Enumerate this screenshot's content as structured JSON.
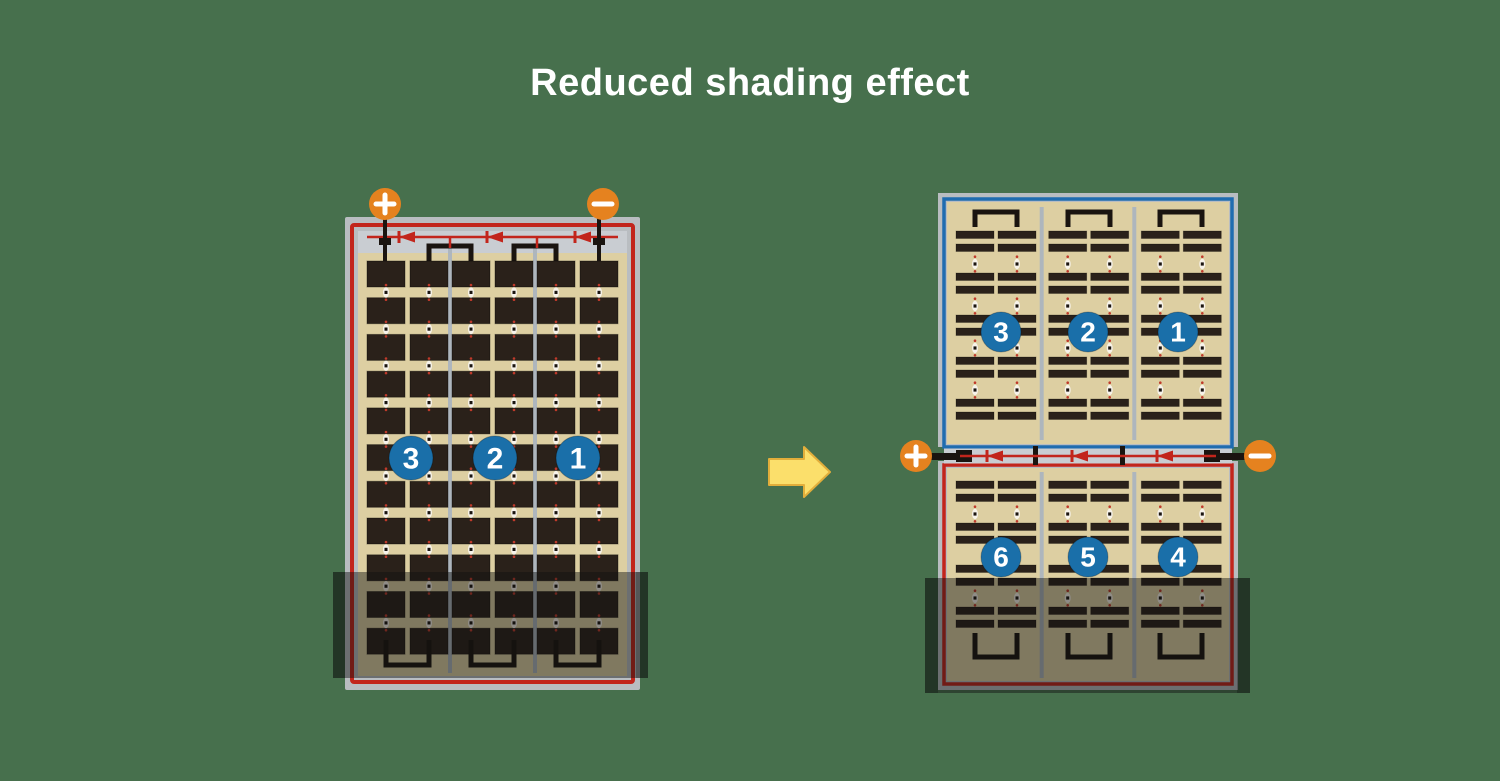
{
  "title": "Reduced shading effect",
  "colors": {
    "background": "#47704d",
    "title_text": "#ffffff",
    "panel_frame": "#b9bdc1",
    "panel_interior": "#ddcfa2",
    "busbar_gray": "#c9cdd2",
    "divider_gray": "#aeb6bd",
    "cell_dark": "#2a211a",
    "wire_red": "#c2251c",
    "wire_blue": "#1f6cb0",
    "wire_black": "#1a1410",
    "terminal_orange": "#e5821f",
    "terminal_symbol": "#ffffff",
    "string_circle_blue": "#1a6fa9",
    "string_circle_text": "#ffffff",
    "arrow_fill": "#fbdf6b",
    "arrow_stroke": "#e2ae3b",
    "shade": "rgba(15,15,15,0.45)",
    "shade_edge": "rgba(0,0,0,0.22)",
    "dot_white": "#f7f3ea",
    "dot_red": "#c03a2b"
  },
  "left_module": {
    "terminals": [
      {
        "symbol": "+"
      },
      {
        "symbol": "−"
      }
    ],
    "bypass_diodes": 3,
    "strings": [
      {
        "label": "3"
      },
      {
        "label": "2"
      },
      {
        "label": "1"
      }
    ],
    "grid": {
      "columns": 6,
      "rows": 11,
      "cell_style": "full"
    },
    "shaded_bottom": true
  },
  "right_module": {
    "terminals": [
      {
        "symbol": "+"
      },
      {
        "symbol": "−"
      }
    ],
    "bypass_diodes": 3,
    "top_half": {
      "border": "blue",
      "strings": [
        {
          "label": "3"
        },
        {
          "label": "2"
        },
        {
          "label": "1"
        }
      ],
      "grid": {
        "columns": 6,
        "bar_rows": 10,
        "cell_style": "half-cut"
      }
    },
    "bottom_half": {
      "border": "red",
      "strings": [
        {
          "label": "6"
        },
        {
          "label": "5"
        },
        {
          "label": "4"
        }
      ],
      "grid": {
        "columns": 6,
        "bar_rows": 8,
        "cell_style": "half-cut"
      },
      "shaded_bottom": true
    }
  },
  "arrow": {
    "direction": "right"
  }
}
